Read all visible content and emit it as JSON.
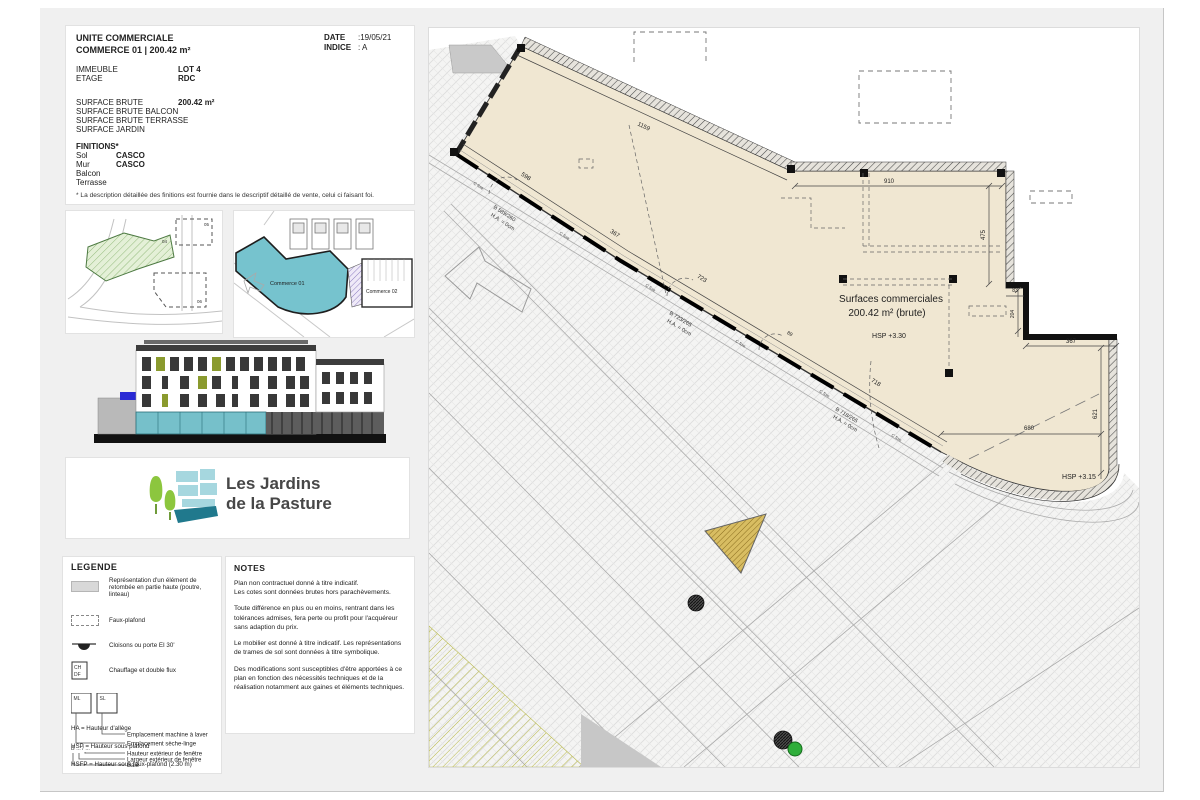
{
  "header": {
    "date_label": "DATE",
    "date_value": ":19/05/21",
    "indice_label": "INDICE",
    "indice_value": ":  A"
  },
  "info": {
    "title": "UNITE COMMERCIALE",
    "subtitle": "COMMERCE 01 | 200.42 m²",
    "immeuble_label": "IMMEUBLE",
    "immeuble_value": "LOT 4",
    "etage_label": "ETAGE",
    "etage_value": "RDC",
    "surface_brute_label": "SURFACE BRUTE",
    "surface_brute_value": "200.42 m²",
    "surface_balcon_label": "SURFACE BRUTE BALCON",
    "surface_terrasse_label": "SURFACE BRUTE TERRASSE",
    "surface_jardin_label": "SURFACE JARDIN",
    "finitions_title": "FINITIONS*",
    "sol_label": "Sol",
    "sol_value": "CASCO",
    "mur_label": "Mur",
    "mur_value": "CASCO",
    "balcon_label": "Balcon",
    "terrasse_label": "Terrasse",
    "footnote": "* La description détaillée des finitions est fournie dans le descriptif détaillé de vente, celui ci faisant foi."
  },
  "keyplan": {
    "lot04": "04",
    "lot05": "05",
    "lot06": "06",
    "commerce01": "Commerce 01",
    "commerce02": "Commerce 02"
  },
  "logo": {
    "line1": "Les Jardins",
    "line2": "de la Pasture"
  },
  "legend": {
    "title": "LEGENDE",
    "item1": "Représentation d'un élément de retombée en partie haute (poutre, linteau)",
    "item2": "Faux-plafond",
    "item3": "Cloisons ou porte EI 30'",
    "item4": "Chauffage et double flux",
    "ch": "CH",
    "df": "DF",
    "ml": "ML",
    "sl": "SL",
    "leader1": "Emplacement machine à laver",
    "leader2": "Emplacement sèche-linge",
    "baie_code": "B ... / ...",
    "baie1": "Hauteur extérieur de fenêtre",
    "baie2": "Largeur extérieur de fenêtre",
    "baie3": "Baie",
    "abbr1": "HA = Hauteur d'allège",
    "abbr2": "HSP = Hauteur sous plafond",
    "abbr3": "HSFP = Hauteur sous faux-plafond (2.30 m)"
  },
  "notes": {
    "title": "NOTES",
    "paragraphs": [
      "Plan non contractuel donné à titre indicatif.",
      "Les cotes sont données brutes hors parachèvements.",
      "Toute différence en plus ou en moins, rentrant dans les tolérances admises, fera perte ou profit pour l'acquéreur sans adaption du prix.",
      "Le mobilier est donné à titre indicatif. Les représentations de trames de sol sont données à titre symbolique.",
      "Des modifications sont susceptibles d'être apportées à ce plan en fonction des nécessités techniques et de la réalisation notamment aux gaines et éléments techniques."
    ]
  },
  "plan": {
    "room_line1": "Surfaces commerciales",
    "room_line2": "200.42 m² (brute)",
    "hsp_main": "HSP  +3.30",
    "hsp_second": "HSP  +3.15",
    "dims": {
      "d1159": "1159",
      "d910": "910",
      "d475": "475",
      "d83": "83",
      "d204": "204",
      "d367r": "367",
      "d621": "621",
      "d680": "680",
      "d598": "598",
      "d367f": "367",
      "d723": "723",
      "d89": "89",
      "d718": "718"
    },
    "windows": {
      "w1": "B 589/260",
      "w1ha": "H.A. = 0cm",
      "w2": "B 723/265",
      "w2ha": "H.A. = 0cm",
      "w3": "B 718/265",
      "w3ha": "H.A. = 0cm"
    },
    "cfixe": "C fixe"
  },
  "colors": {
    "accent_teal": "#76c3ce",
    "room_beige": "#f0e7d2",
    "logo_green": "#8cc63e",
    "logo_dark_teal": "#20798d"
  }
}
